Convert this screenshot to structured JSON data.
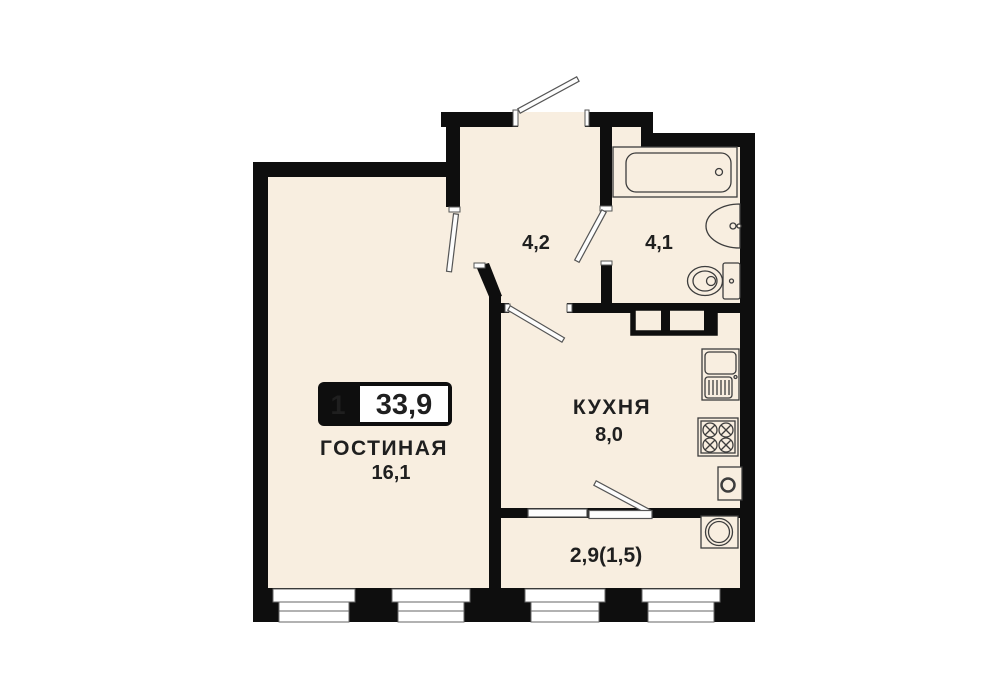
{
  "plan": {
    "badge": {
      "rooms": "1",
      "total_area": "33,9"
    },
    "rooms": [
      {
        "id": "living",
        "name": "ГОСТИНАЯ",
        "area": "16,1"
      },
      {
        "id": "hallway",
        "name": "",
        "area": "4,2"
      },
      {
        "id": "bathroom",
        "name": "",
        "area": "4,1"
      },
      {
        "id": "kitchen",
        "name": "КУХНЯ",
        "area": "8,0"
      },
      {
        "id": "balcony",
        "name": "",
        "area": "2,9(1,5)"
      }
    ],
    "colors": {
      "wall": "#0e0e0e",
      "floor": "#f8eee0",
      "background": "#ffffff",
      "text": "#1f1f1f",
      "fixture_line": "#3d3d3d",
      "door_fill": "#fdfdfd"
    }
  }
}
